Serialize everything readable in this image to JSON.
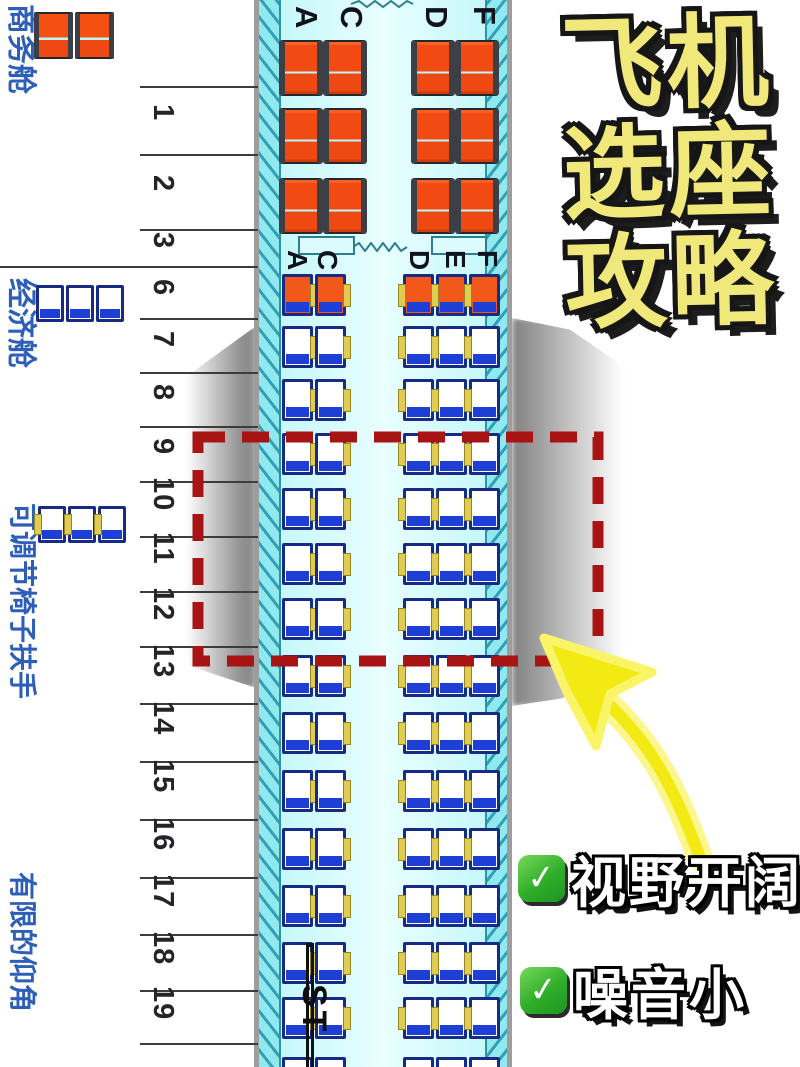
{
  "title": {
    "lines": [
      "飞机",
      "选座",
      "攻略"
    ]
  },
  "sidebar": {
    "business_label": "商务舱",
    "economy_label": "经济舱",
    "adjustable_armrest_label": "可调节椅子扶手",
    "limited_recline_label": "有限的仰角"
  },
  "seat_map": {
    "business": {
      "columns": [
        "A",
        "C",
        "D",
        "F"
      ],
      "row_numbers": [
        "1",
        "2",
        "3"
      ]
    },
    "economy": {
      "columns": [
        "A",
        "C",
        "D",
        "E",
        "F"
      ],
      "row_numbers": [
        "6",
        "7",
        "8",
        "9",
        "10",
        "11",
        "12",
        "13",
        "14",
        "15",
        "16",
        "17",
        "18",
        "19"
      ],
      "orange_rows": [
        "6"
      ]
    },
    "watermark": "ST"
  },
  "highlight": {
    "style": "red-dashed-box",
    "rows_covered": "9-12"
  },
  "benefits": [
    {
      "icon": "check-emoji",
      "text": "视野开阔"
    },
    {
      "icon": "check-emoji",
      "text": "噪音小"
    }
  ],
  "colors": {
    "business_seat": "#f14a12",
    "economy_seat_cushion": "#1d3fd6",
    "armrest_accent": "#e0cc52",
    "fuselage": "#c6f8fa",
    "highlight_dash": "#a81313",
    "title_fill": "#f1e87c",
    "arrow": "#f2ea12",
    "check_green": "#2fae2a",
    "label_blue": "#2d5fb8"
  }
}
